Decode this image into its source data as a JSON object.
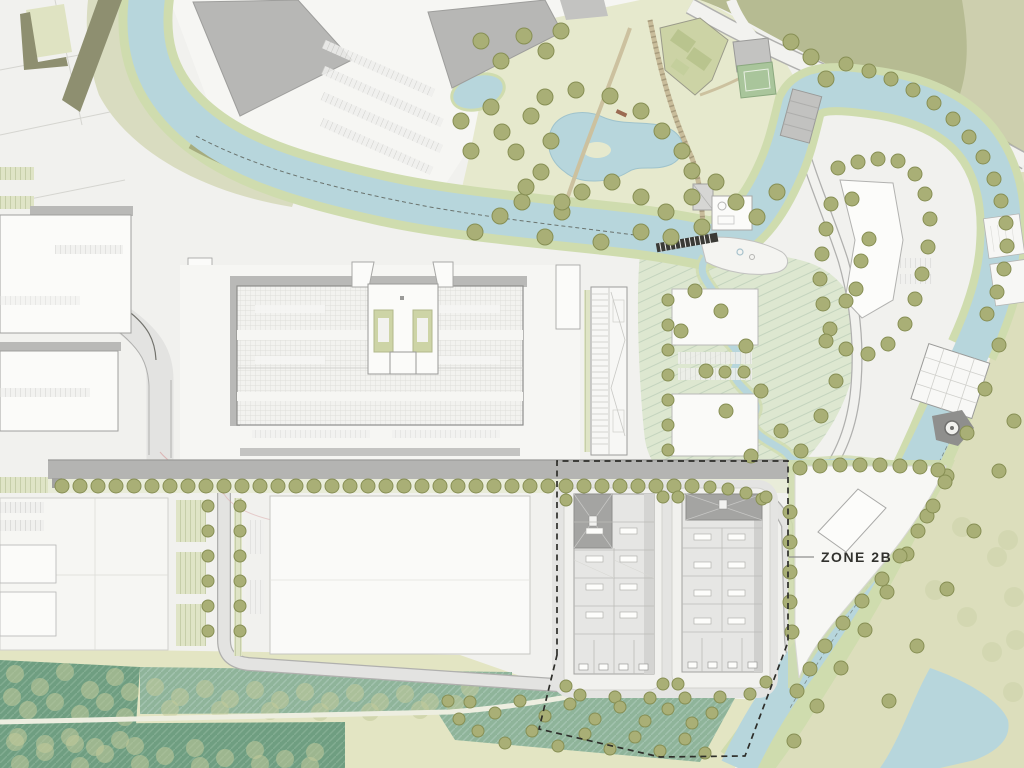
{
  "plan": {
    "zone_label": "ZONE 2B",
    "type": "masterplan-site-plan"
  },
  "colors": {
    "base": "#f1f1ee",
    "urbanWhite": "#f6f6f3",
    "water": "#b7d6dc",
    "waterEdge": "#9fc3cc",
    "bank": "#cfdcae",
    "bankOlive": "#a6ac7e",
    "park": "#e6e9cd",
    "parkPale": "#d9dcc0",
    "contour": "#dde7d0",
    "contourLine": "#c4d4be",
    "oliveField": "#b6bb92",
    "oliveFieldLight": "#cdcfae",
    "beigeField": "#dcdebc",
    "southField": "#e3e5c3",
    "tealDark": "#6f9e81",
    "tealLight": "#8fb49a",
    "hatchDark": "#82ad92",
    "hatchLight": "#a2c2ae",
    "tree": "#a9af76",
    "treeStroke": "#878f54",
    "treeGhost": "#c2cb9b",
    "roadLight": "#e3e3e1",
    "roadWhite": "#f2f2ef",
    "roadCasing": "#b0b0ae",
    "boulevard": "#b4b4b2",
    "roadEdgeDark": "#55554f",
    "buildingWhite": "#fbfbf9",
    "buildingStroke": "#a0a09e",
    "grayBuilding": "#b7b7b5",
    "grayBuildingStroke": "#9e9e9c",
    "darkUnit": "#a4a4a2",
    "unitLine": "#bcbcb8",
    "grayBand": "#b9b9b7",
    "stallGreen": "#dfe4c6",
    "stallLine": "#aeb98c",
    "stallGray": "#f0f0ee",
    "stallGrayLine": "#c9c9c5",
    "court": "#a9c59b",
    "courtGray": "#c3c3c1",
    "allotment": "#ccd3a5",
    "dash": "#2e2e2a",
    "label": "#32322e",
    "leader": "#8f8f8d",
    "weir": "#3a3a36",
    "terrace": "#f4f4f1",
    "pinkRoute": "#d9a3a3"
  }
}
